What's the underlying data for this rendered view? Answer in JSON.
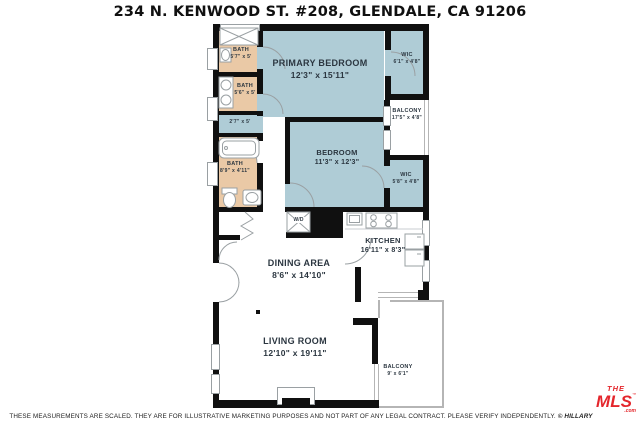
{
  "title": "234 N. KENWOOD ST. #208, GLENDALE, CA 91206",
  "colors": {
    "bedroom_fill": "#afccd6",
    "bath_fill": "#eac9a6",
    "wall": "#101010",
    "balcony_wall": "#b5b5b5",
    "logo_red": "#e4262c"
  },
  "rooms": {
    "primary_bedroom": {
      "name": "PRIMARY BEDROOM",
      "dims": "12'3\" x 15'11\""
    },
    "bedroom": {
      "name": "BEDROOM",
      "dims": "11'3\" x 12'3\""
    },
    "wic_top": {
      "name": "WIC",
      "dims": "6'1\" x 4'8\""
    },
    "balcony_right": {
      "name": "BALCONY",
      "dims": "17'5\" x 4'8\""
    },
    "wic_lower": {
      "name": "WIC",
      "dims": "5'8\" x 4'8\""
    },
    "bath_top": {
      "name": "BATH",
      "dims": "5'7\" x 5'"
    },
    "bath_mid": {
      "name": "BATH",
      "dims": "5'6\" x 5'"
    },
    "closet": {
      "dims": "2'7\" x 5'"
    },
    "bath_lower": {
      "name": "BATH",
      "dims": "8'9\" x 4'11\""
    },
    "laundry": {
      "name": "W/D"
    },
    "kitchen": {
      "name": "KITCHEN",
      "dims": "16'11\" x 8'3\""
    },
    "dining": {
      "name": "DINING AREA",
      "dims": "8'6\" x 14'10\""
    },
    "living": {
      "name": "LIVING ROOM",
      "dims": "12'10\" x 19'11\""
    },
    "balcony_bottom": {
      "name": "BALCONY",
      "dims": "9' x 6'1\""
    }
  },
  "footer": {
    "disclaimer": "THESE MEASUREMENTS ARE SCALED.  THEY ARE FOR ILLUSTRATIVE MARKETING PURPOSES AND NOT PART OF ANY LEGAL CONTRACT.  PLEASE VERIFY INDEPENDENTLY.",
    "copyright": "© HILLARY CAMPBELL"
  },
  "logo": {
    "the": "THE",
    "mls": "MLS",
    "tm": "™",
    "com": ".com"
  }
}
